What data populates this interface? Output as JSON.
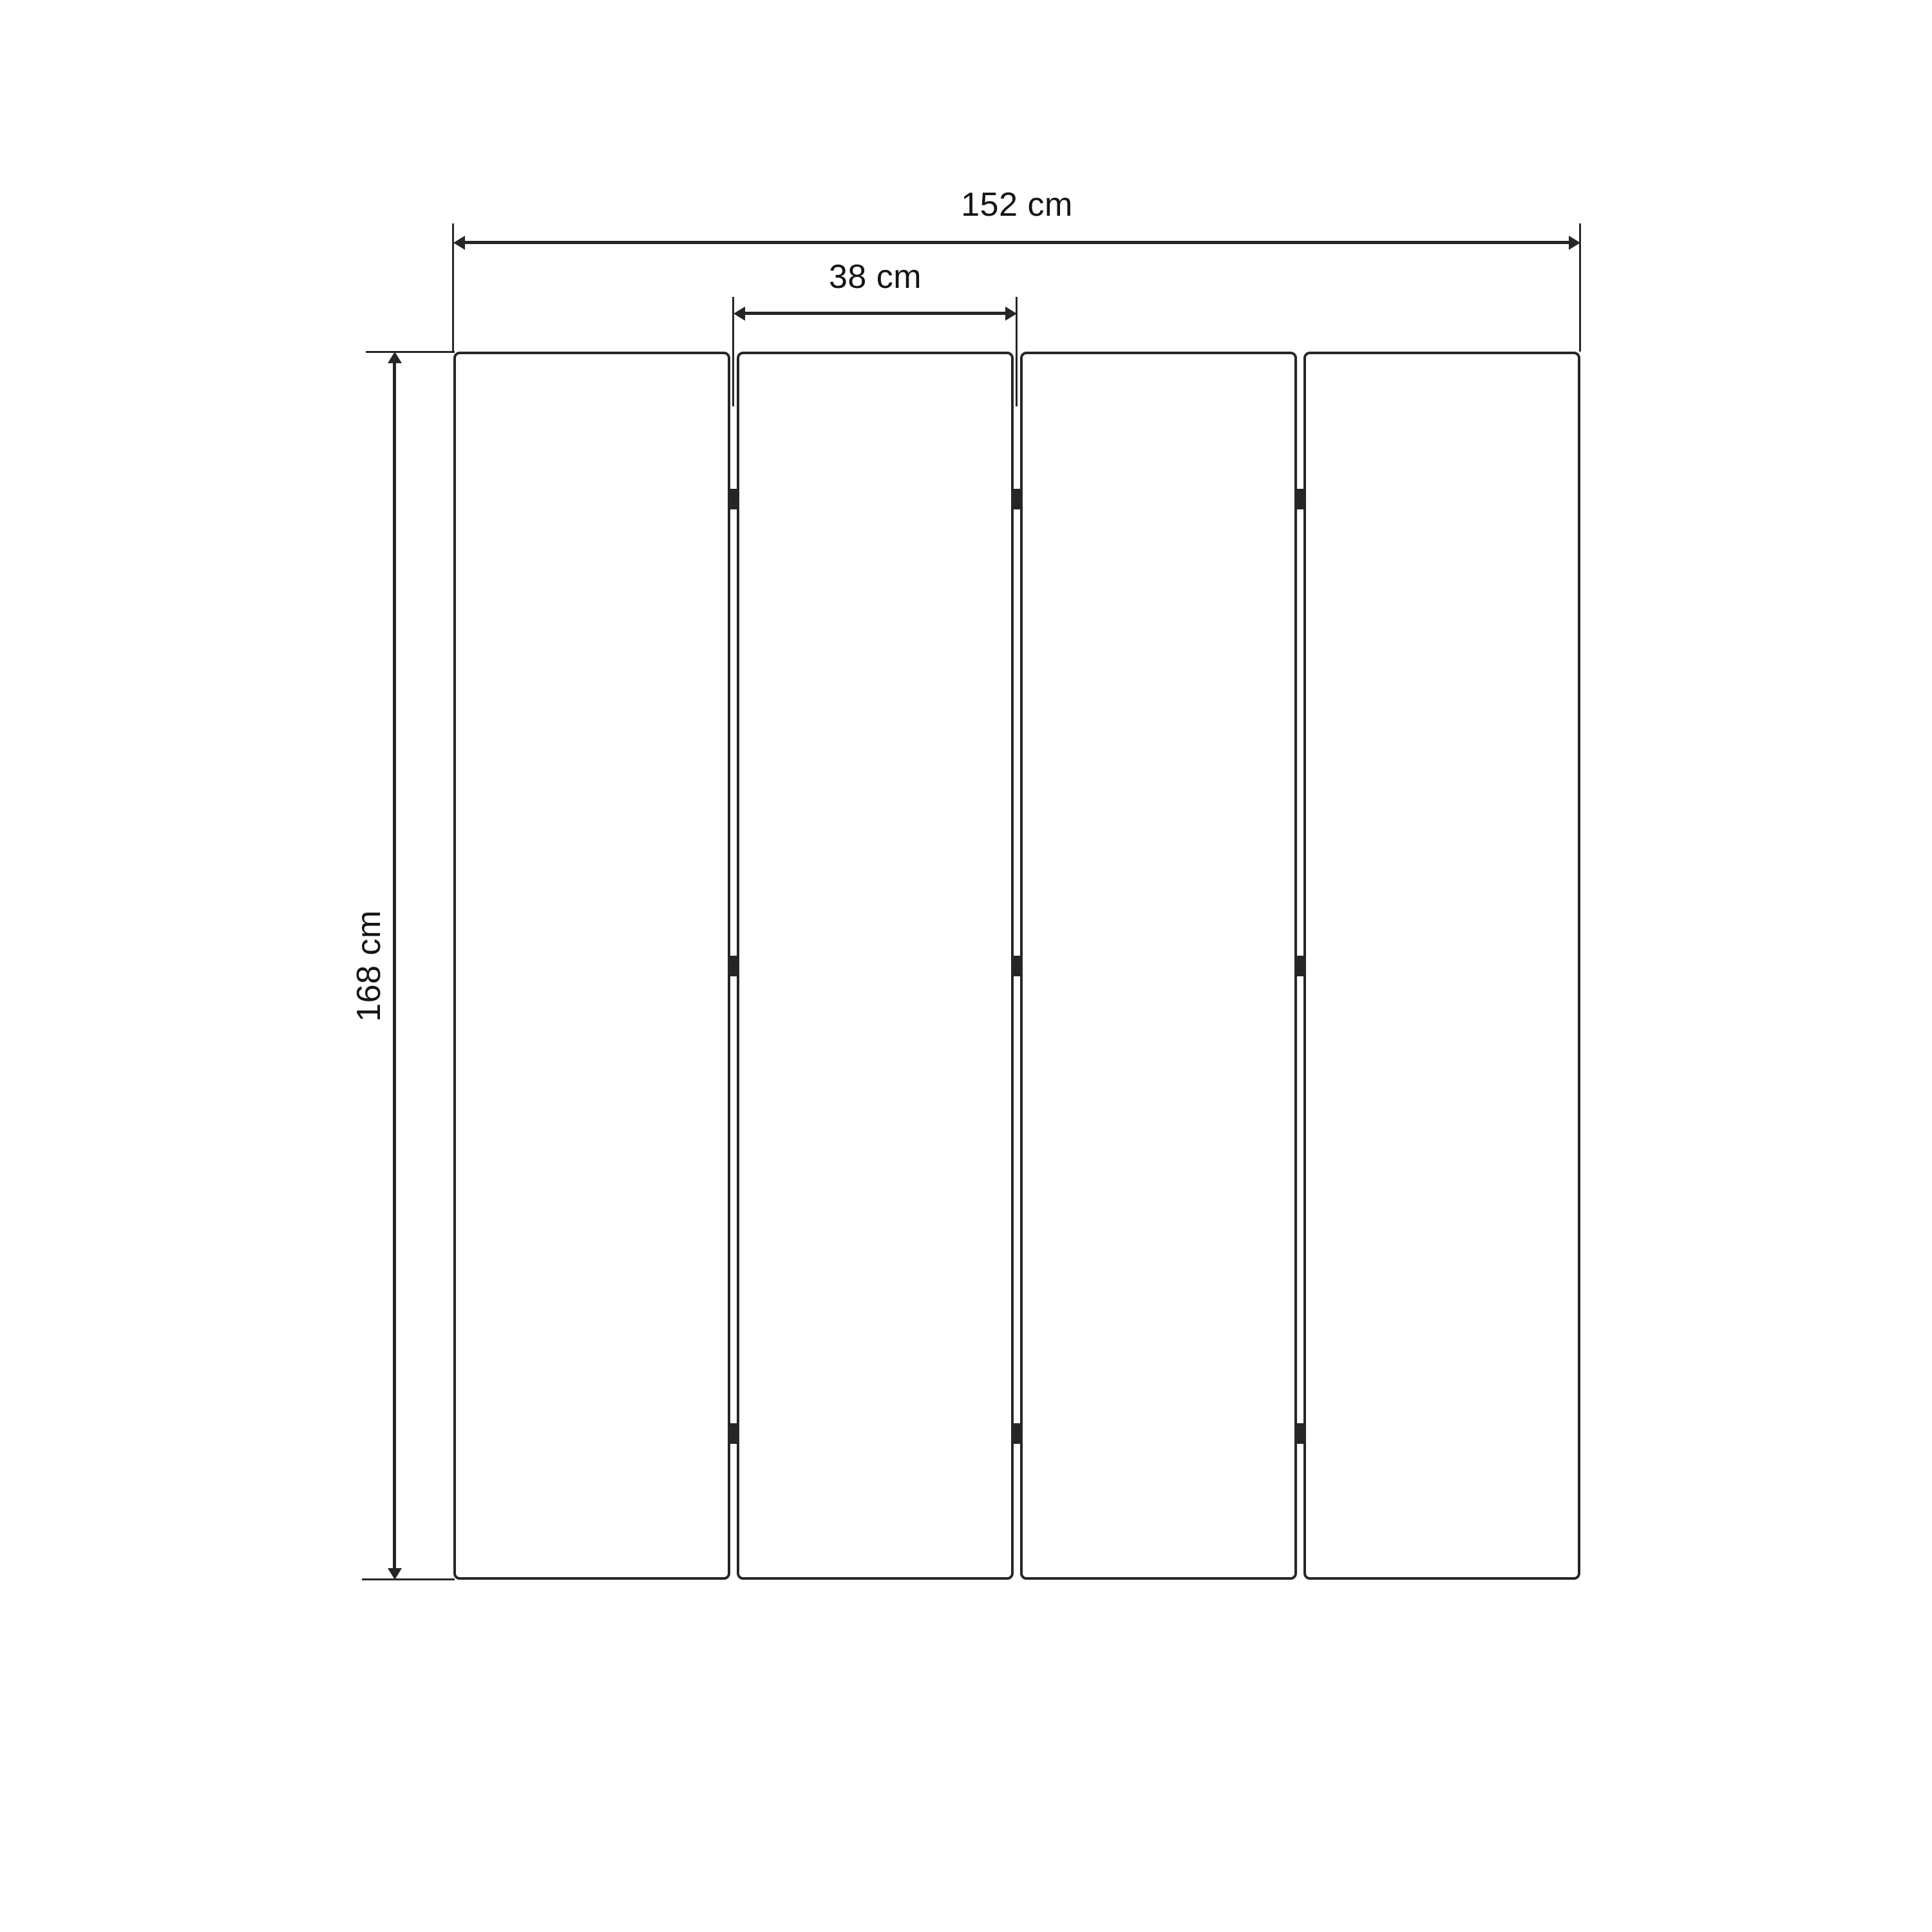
{
  "diagram": {
    "panel_count": 4,
    "hinges_per_gap": 3,
    "dimensions": {
      "total_width": {
        "label": "152 cm",
        "value": 152,
        "unit": "cm",
        "orientation": "horizontal"
      },
      "panel_width": {
        "label": "38 cm",
        "value": 38,
        "unit": "cm",
        "orientation": "horizontal"
      },
      "height": {
        "label": "168 cm",
        "value": 168,
        "unit": "cm",
        "orientation": "vertical"
      }
    },
    "colors": {
      "line": "#262626",
      "text": "#141414",
      "background": "#ffffff",
      "panel_fill": "#ffffff"
    }
  }
}
